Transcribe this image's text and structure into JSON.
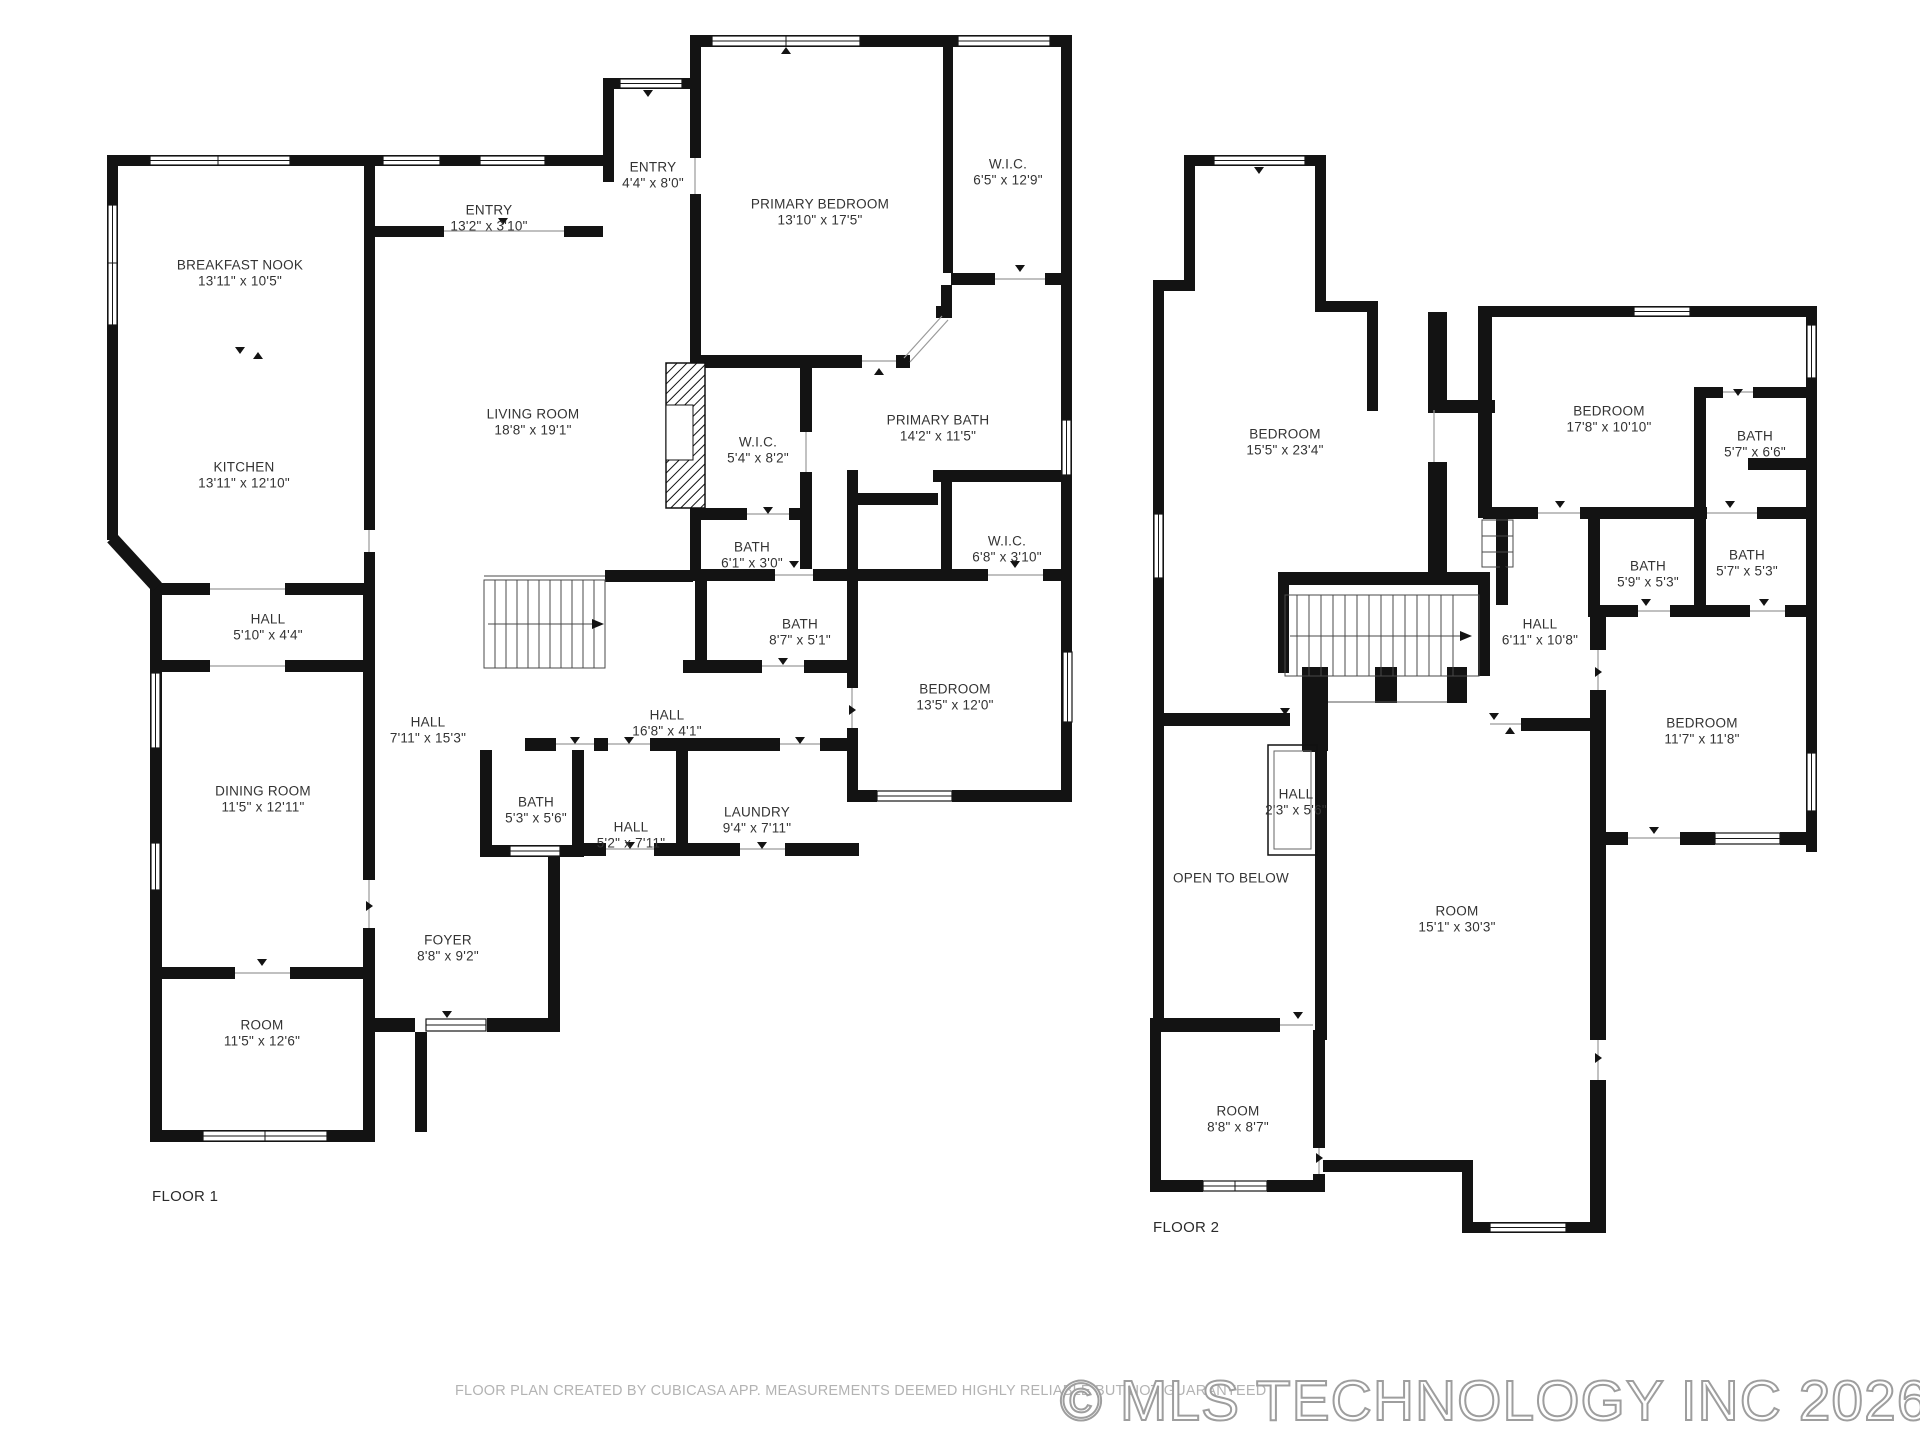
{
  "footer": {
    "disclaimer": "FLOOR PLAN CREATED BY CUBICASA APP. MEASUREMENTS DEEMED HIGHLY RELIABLE BUT NOT GUARANTEED",
    "copyright": "© MLS TECHNOLOGY INC 2026"
  },
  "floors": [
    {
      "name": "FLOOR 1",
      "rooms": [
        {
          "label": "BREAKFAST NOOK",
          "dims": "13'11\" x 10'5\""
        },
        {
          "label": "ENTRY",
          "dims": "13'2\" x 3'10\""
        },
        {
          "label": "ENTRY",
          "dims": "4'4\" x 8'0\""
        },
        {
          "label": "PRIMARY BEDROOM",
          "dims": "13'10\" x 17'5\""
        },
        {
          "label": "W.I.C.",
          "dims": "6'5\" x 12'9\""
        },
        {
          "label": "LIVING ROOM",
          "dims": "18'8\" x 19'1\""
        },
        {
          "label": "W.I.C.",
          "dims": "5'4\" x 8'2\""
        },
        {
          "label": "PRIMARY BATH",
          "dims": "14'2\" x 11'5\""
        },
        {
          "label": "BATH",
          "dims": "6'1\" x 3'0\""
        },
        {
          "label": "W.I.C.",
          "dims": "6'8\" x 3'10\""
        },
        {
          "label": "KITCHEN",
          "dims": "13'11\" x 12'10\""
        },
        {
          "label": "HALL",
          "dims": "5'10\" x 4'4\""
        },
        {
          "label": "BATH",
          "dims": "8'7\" x 5'1\""
        },
        {
          "label": "BEDROOM",
          "dims": "13'5\" x 12'0\""
        },
        {
          "label": "HALL",
          "dims": "7'11\" x 15'3\""
        },
        {
          "label": "HALL",
          "dims": "16'8\" x 4'1\""
        },
        {
          "label": "DINING ROOM",
          "dims": "11'5\" x 12'11\""
        },
        {
          "label": "BATH",
          "dims": "5'3\" x 5'6\""
        },
        {
          "label": "HALL",
          "dims": "5'2\" x 7'11\""
        },
        {
          "label": "LAUNDRY",
          "dims": "9'4\" x 7'11\""
        },
        {
          "label": "FOYER",
          "dims": "8'8\" x 9'2\""
        },
        {
          "label": "ROOM",
          "dims": "11'5\" x 12'6\""
        }
      ]
    },
    {
      "name": "FLOOR 2",
      "rooms": [
        {
          "label": "BEDROOM",
          "dims": "15'5\" x 23'4\""
        },
        {
          "label": "BEDROOM",
          "dims": "17'8\" x 10'10\""
        },
        {
          "label": "BATH",
          "dims": "5'7\" x 6'6\""
        },
        {
          "label": "BATH",
          "dims": "5'9\" x 5'3\""
        },
        {
          "label": "BATH",
          "dims": "5'7\" x 5'3\""
        },
        {
          "label": "HALL",
          "dims": "6'11\" x 10'8\""
        },
        {
          "label": "BEDROOM",
          "dims": "11'7\" x 11'8\""
        },
        {
          "label": "HALL",
          "dims": "2'3\" x 5'6\""
        },
        {
          "label": "OPEN TO BELOW",
          "dims": ""
        },
        {
          "label": "ROOM",
          "dims": "15'1\" x 30'3\""
        },
        {
          "label": "ROOM",
          "dims": "8'8\" x 8'7\""
        }
      ]
    }
  ]
}
